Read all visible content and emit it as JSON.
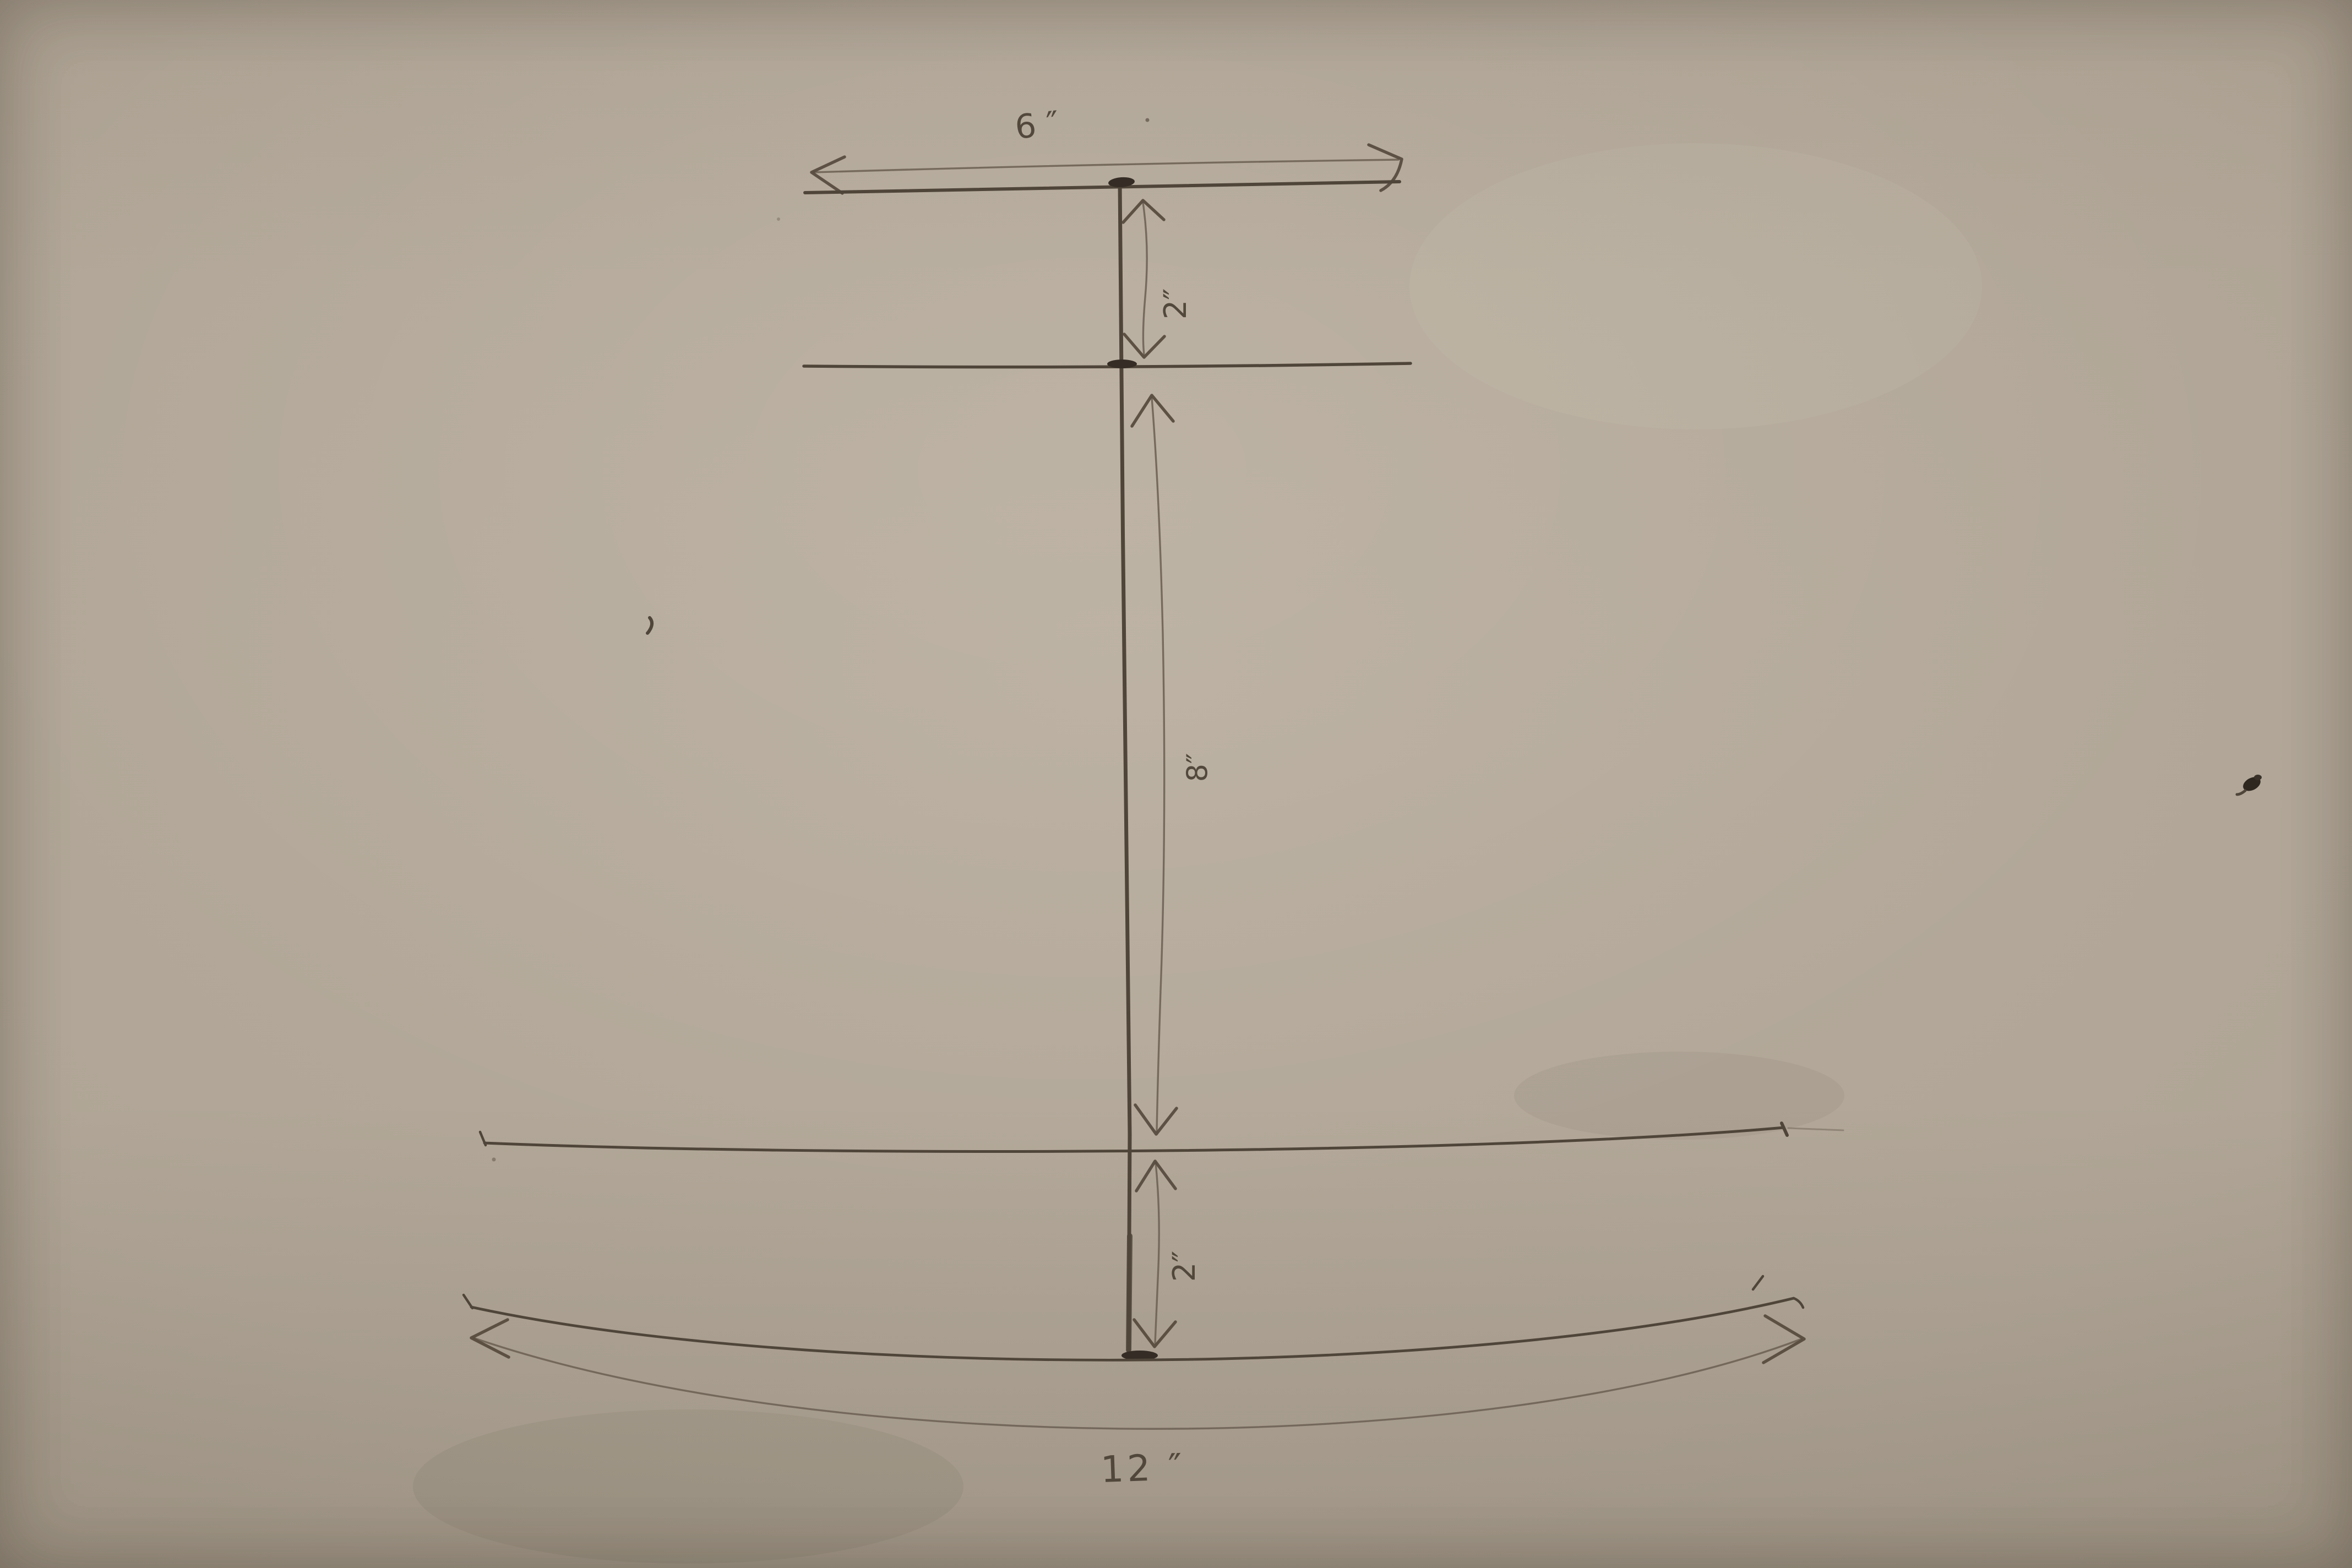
{
  "drawing": {
    "labels": {
      "top_width": "6 ″",
      "top_flange_thickness": "2″",
      "web_height": "8″",
      "bottom_flange_thickness": "2″",
      "bottom_width": "12  ″"
    },
    "dimensions_inches": {
      "top_flange_width": 6,
      "top_flange_thickness": 2,
      "web_height": 8,
      "bottom_flange_thickness": 2,
      "bottom_flange_width": 12
    },
    "colors": {
      "paper_center": "#b2a797",
      "paper_edge": "#867b6c",
      "pencil_dark": "#4b4237",
      "pencil_light": "#6e6355"
    }
  }
}
